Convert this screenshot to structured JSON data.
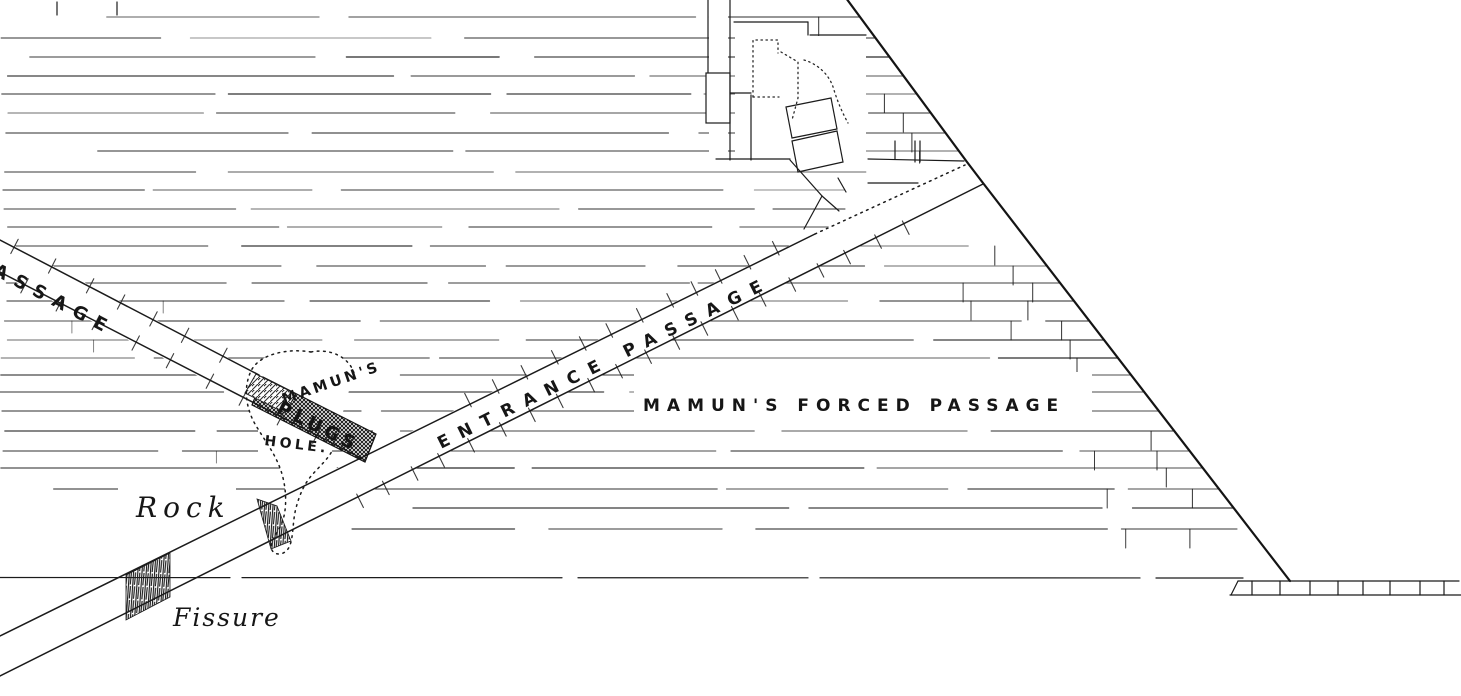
{
  "diagram": {
    "type": "engraved cross-section of the Great Pyramid entrance passages",
    "labels": {
      "ascending_passage_partial": "ASSAGE",
      "entrance_passage": "ENTRANCE  PASSAGE",
      "mamuns": "MAMUN'S",
      "plugs": "PLUGS",
      "hole": "HOLE.",
      "mamuns_forced_passage": "MAMUN'S  FORCED  PASSAGE",
      "rock": "Rock",
      "fissure": "Fissure"
    },
    "colors": {
      "ink": "#1b1b1b",
      "paper": "#ffffff"
    }
  }
}
